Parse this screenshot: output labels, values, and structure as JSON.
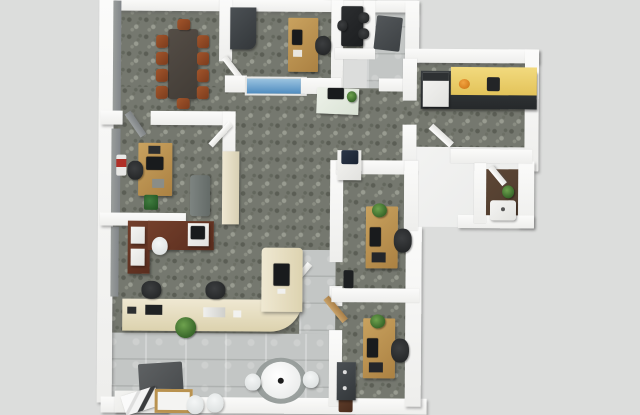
{
  "scene": {
    "type": "3d-floor-plan-top-down-render",
    "setting": "office-suite",
    "rooms": [
      {
        "name": "conference-room",
        "floor": "gray-mottled-carpet",
        "furniture": [
          "dark-conference-table",
          "ten-brown-chairs"
        ]
      },
      {
        "name": "private-office-top",
        "floor": "gray-mottled-carpet",
        "furniture": [
          "corner-cabinet",
          "wood-desk",
          "task-chair",
          "interior-window"
        ]
      },
      {
        "name": "meeting-nook",
        "floor": "dark-carpet",
        "furniture": [
          "black-table",
          "black-chairs"
        ]
      },
      {
        "name": "entry-vestibule",
        "floor": "light-tile",
        "furniture": [
          "dark-floor-mat"
        ]
      },
      {
        "name": "kitchen",
        "floor": "gray-mottled-carpet",
        "furniture": [
          "black-counter-run",
          "yellow-countertop",
          "white-fridge",
          "orange-bowl",
          "coffee-maker"
        ]
      },
      {
        "name": "bathroom",
        "floor": "dark-wood",
        "furniture": [
          "white-sink",
          "potted-plant"
        ]
      },
      {
        "name": "office-left",
        "floor": "gray-mottled-carpet",
        "furniture": [
          "wood-desk",
          "monitor",
          "task-chair",
          "green-bin",
          "gray-sofa",
          "cream-bookcase",
          "wall-art"
        ]
      },
      {
        "name": "open-workstation",
        "floor": "gray-mottled-carpet",
        "furniture": [
          "mahogany-l-desk",
          "white-drawers",
          "white-chair",
          "monitor"
        ]
      },
      {
        "name": "reception",
        "floor": "carpet-behind-tile-front",
        "furniture": [
          "curved-cream-counter",
          "two-task-chairs",
          "counter-monitor",
          "laptop",
          "desk-plant"
        ]
      },
      {
        "name": "lobby",
        "floor": "light-tile",
        "furniture": [
          "dark-rug",
          "printer-on-stand",
          "wood-trim-table",
          "two-white-chairs",
          "round-white-table",
          "two-white-stools",
          "brown-mat"
        ]
      },
      {
        "name": "office-center",
        "floor": "gray-mottled-carpet",
        "furniture": [
          "wood-desk",
          "monitor",
          "task-chair",
          "desk-plant",
          "black-bin",
          "printer-stand"
        ]
      },
      {
        "name": "office-bottom",
        "floor": "gray-mottled-carpet",
        "furniture": [
          "wood-desk",
          "monitor",
          "task-chair",
          "desk-plant",
          "dark-cabinet"
        ]
      }
    ]
  },
  "colors": {
    "bg": "#dcdddc",
    "carpet": "#75786f",
    "tile": "#c3c6c5",
    "wall": "#f7f7f5",
    "counter": "#ece4cb",
    "counter-edge": "#d9cfae",
    "kitchen-top": "#eed26e",
    "kitchen-base": "#35393b",
    "conf-table": "#4a443e",
    "conf-chair": "#96502a",
    "mahogany": "#6b3826",
    "desk-tan": "#bd9455",
    "plant-green": "#4a7a38",
    "accent-orange": "#e08820",
    "bath-floor-brown": "#56412f"
  }
}
